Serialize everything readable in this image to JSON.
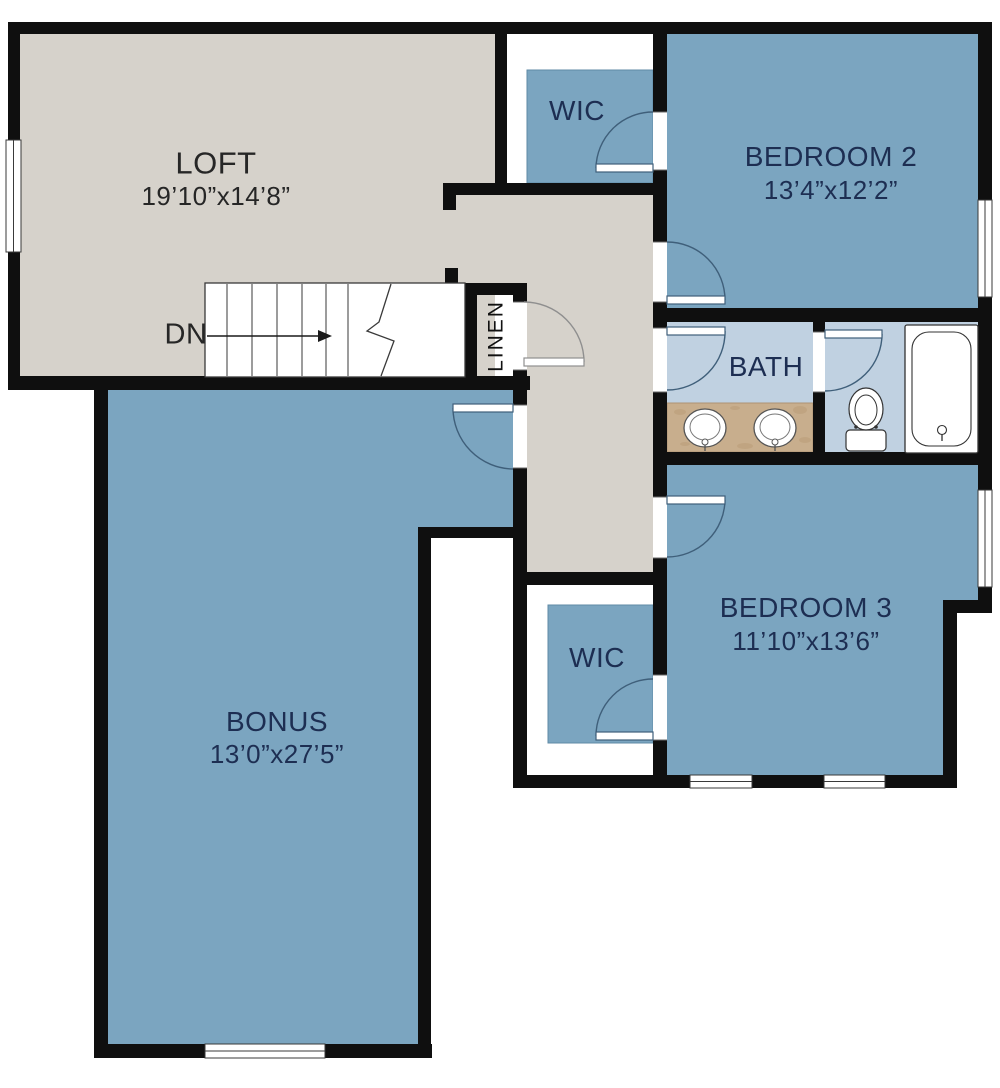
{
  "document": {
    "type": "floor-plan",
    "floor_label": "upper floor"
  },
  "rooms": {
    "loft": {
      "label": "LOFT",
      "dims": "19’10”x14’8”"
    },
    "bonus": {
      "label": "BONUS",
      "dims": "13’0”x27’5”"
    },
    "bedroom2": {
      "label": "BEDROOM 2",
      "dims": "13’4”x12’2”"
    },
    "bedroom3": {
      "label": "BEDROOM 3",
      "dims": "11’10”x13’6”"
    },
    "bath": {
      "label": "BATH"
    },
    "wic_top": {
      "label": "WIC"
    },
    "wic_bottom": {
      "label": "WIC"
    },
    "linen": {
      "label": "LINEN"
    },
    "stairs": {
      "label": "DN"
    }
  },
  "colors": {
    "wall": "#0F0F0F",
    "room_blue": "#7BA5C0",
    "bath_blue": "#C0D1E1",
    "floor_beige": "#D6D2CB",
    "vanity_counter": "#C8AE8D",
    "label_navy": "#1D2E52",
    "label_dark": "#262626"
  }
}
